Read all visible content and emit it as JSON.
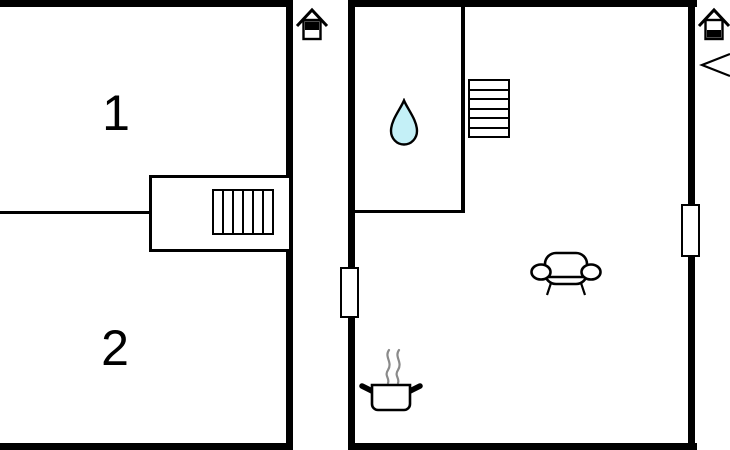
{
  "colors": {
    "wall": "#000000",
    "background": "#ffffff",
    "drop_fill": "#c4f0f7",
    "steam": "#8a8a8a"
  },
  "upper_floor": {
    "room_labels": [
      "1",
      "2"
    ],
    "indicator_icon": "house-upper-half-filled",
    "features": [
      "staircase"
    ]
  },
  "ground_floor": {
    "indicator_icon": "house-lower-half-filled",
    "features": [
      "bathroom-water-drop",
      "staircase",
      "sofa",
      "cooking-pot",
      "window-left-wall",
      "window-right-wall",
      "entrance-arrow"
    ]
  }
}
